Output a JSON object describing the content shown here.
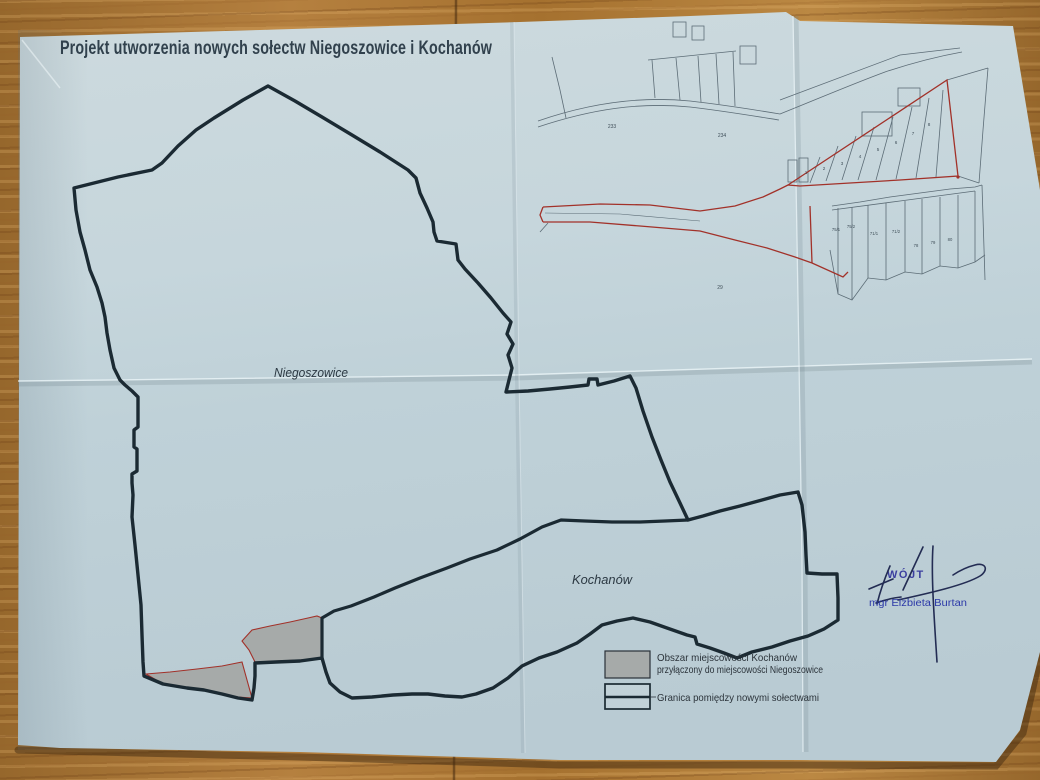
{
  "title": "Projekt utworzenia nowych sołectw Niegoszowice i Kochanów",
  "map": {
    "label_niegoszowice": "Niegoszowice",
    "label_kochanow": "Kochanów"
  },
  "legend": {
    "annexed_line1": "Obszar miejscowości Kochanów",
    "annexed_line2": "przyłączony do miejscowości Niegoszowice",
    "boundary_label": "Granica pomiędzy nowymi sołectwami"
  },
  "signature": {
    "stamp_label": "WÓJT",
    "signer_name": "mgr Elżbieta Burtan"
  },
  "inset": {
    "fan_parcel_numbers": [
      "1",
      "2",
      "3",
      "4",
      "5",
      "6",
      "7",
      "8"
    ],
    "strip_parcel_numbers": [
      "75/1",
      "75/2",
      "71/1",
      "71/2",
      "78",
      "79",
      "80"
    ],
    "open_parcel_numbers": [
      "233",
      "234",
      "29"
    ]
  },
  "colors": {
    "paper": "#c4d5db",
    "wood": "#a9763a",
    "boundary_line": "#1b2a33",
    "red_line": "#a23129",
    "annexed_fill": "#a6aaa9",
    "inset_line": "#5c6c76",
    "stamp_blue": "#31339b",
    "signature_ink": "#232c53",
    "title_text": "#31414d"
  }
}
